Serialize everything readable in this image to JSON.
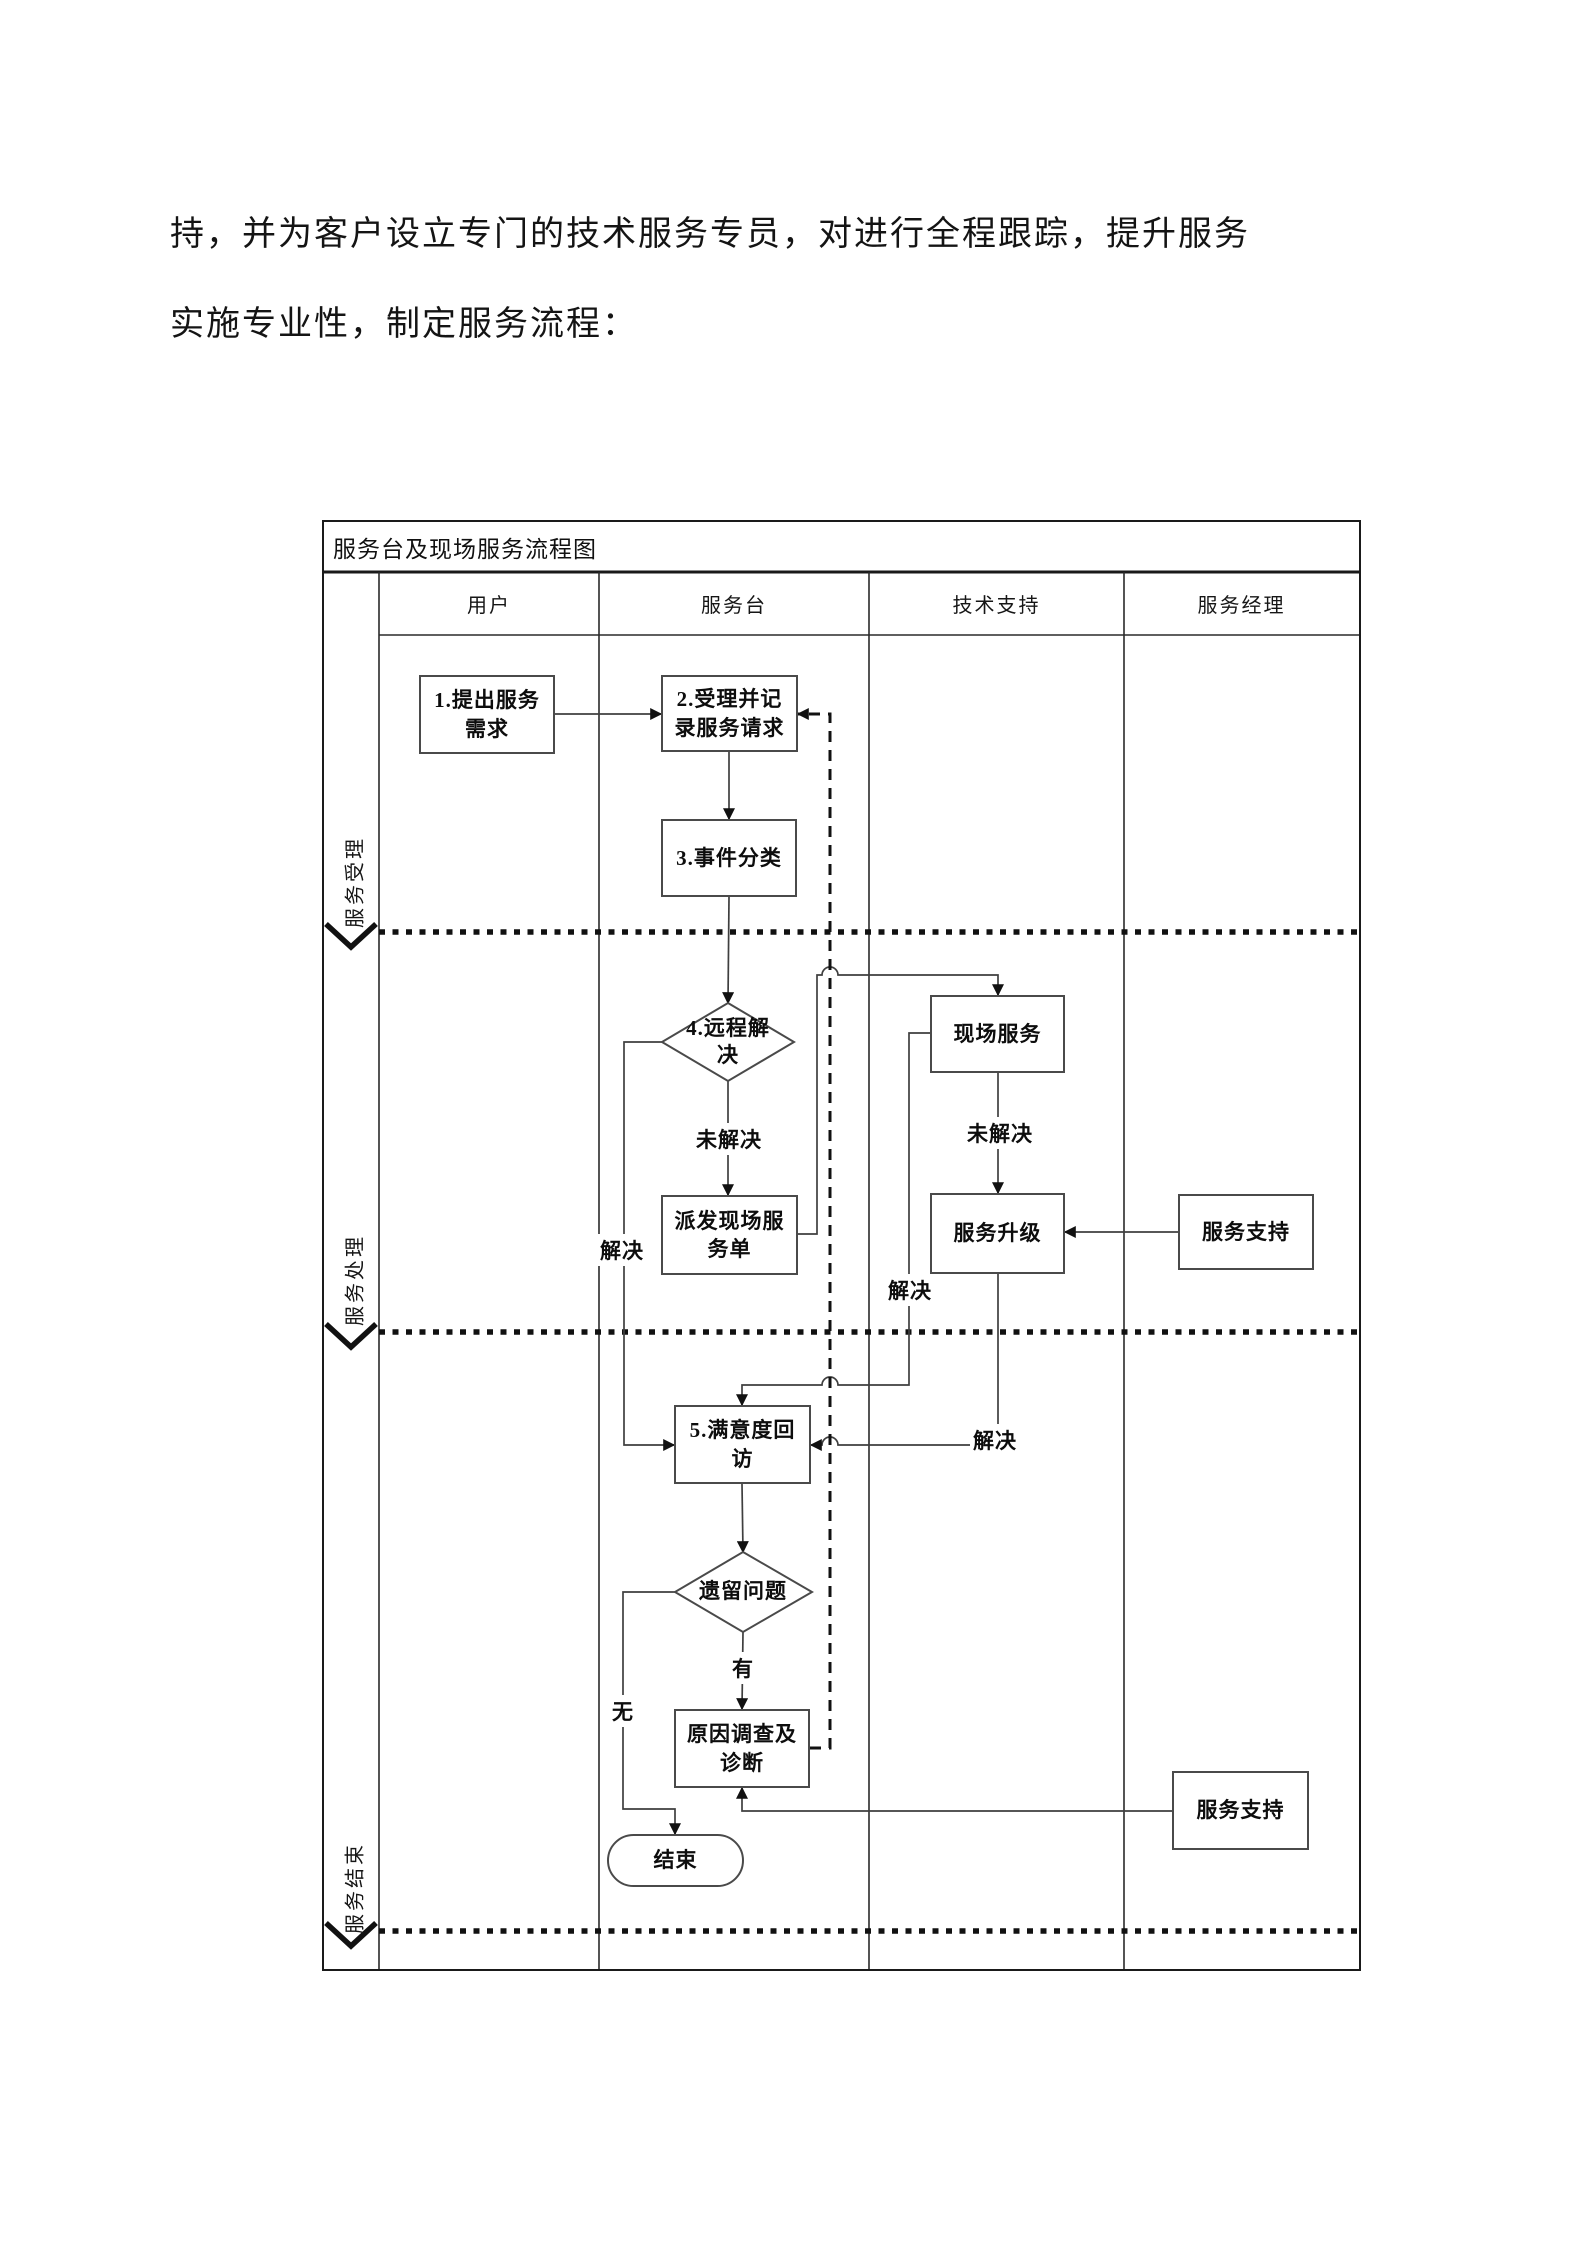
{
  "paragraph": {
    "line1": "持，并为客户设立专门的技术服务专员，对进行全程跟踪，提升服务",
    "line2": "实施专业性，制定服务流程："
  },
  "flowchart": {
    "title": "服务台及现场服务流程图",
    "columns": [
      "用户",
      "服务台",
      "技术支持",
      "服务经理"
    ],
    "phases": [
      "服务受理",
      "服务处理",
      "服务结束"
    ],
    "nodes": {
      "request": "1.提出服务需求",
      "accept": "2.受理并记录服务请求",
      "classify": "3.事件分类",
      "remote": "4.远程解决",
      "dispatch": "派发现场服务单",
      "onsite": "现场服务",
      "escalate": "服务升级",
      "support_top": "服务支持",
      "survey": "5.满意度回访",
      "pending": "遗留问题",
      "investigate": "原因调查及诊断",
      "end": "结束",
      "support_bottom": "服务支持"
    },
    "edge_labels": {
      "resolved": "解决",
      "unresolved": "未解决",
      "has": "有",
      "none": "无"
    },
    "colors": {
      "line": "#3f3f3f",
      "border": "#4a4a4a",
      "text": "#111111",
      "background": "#ffffff"
    }
  }
}
